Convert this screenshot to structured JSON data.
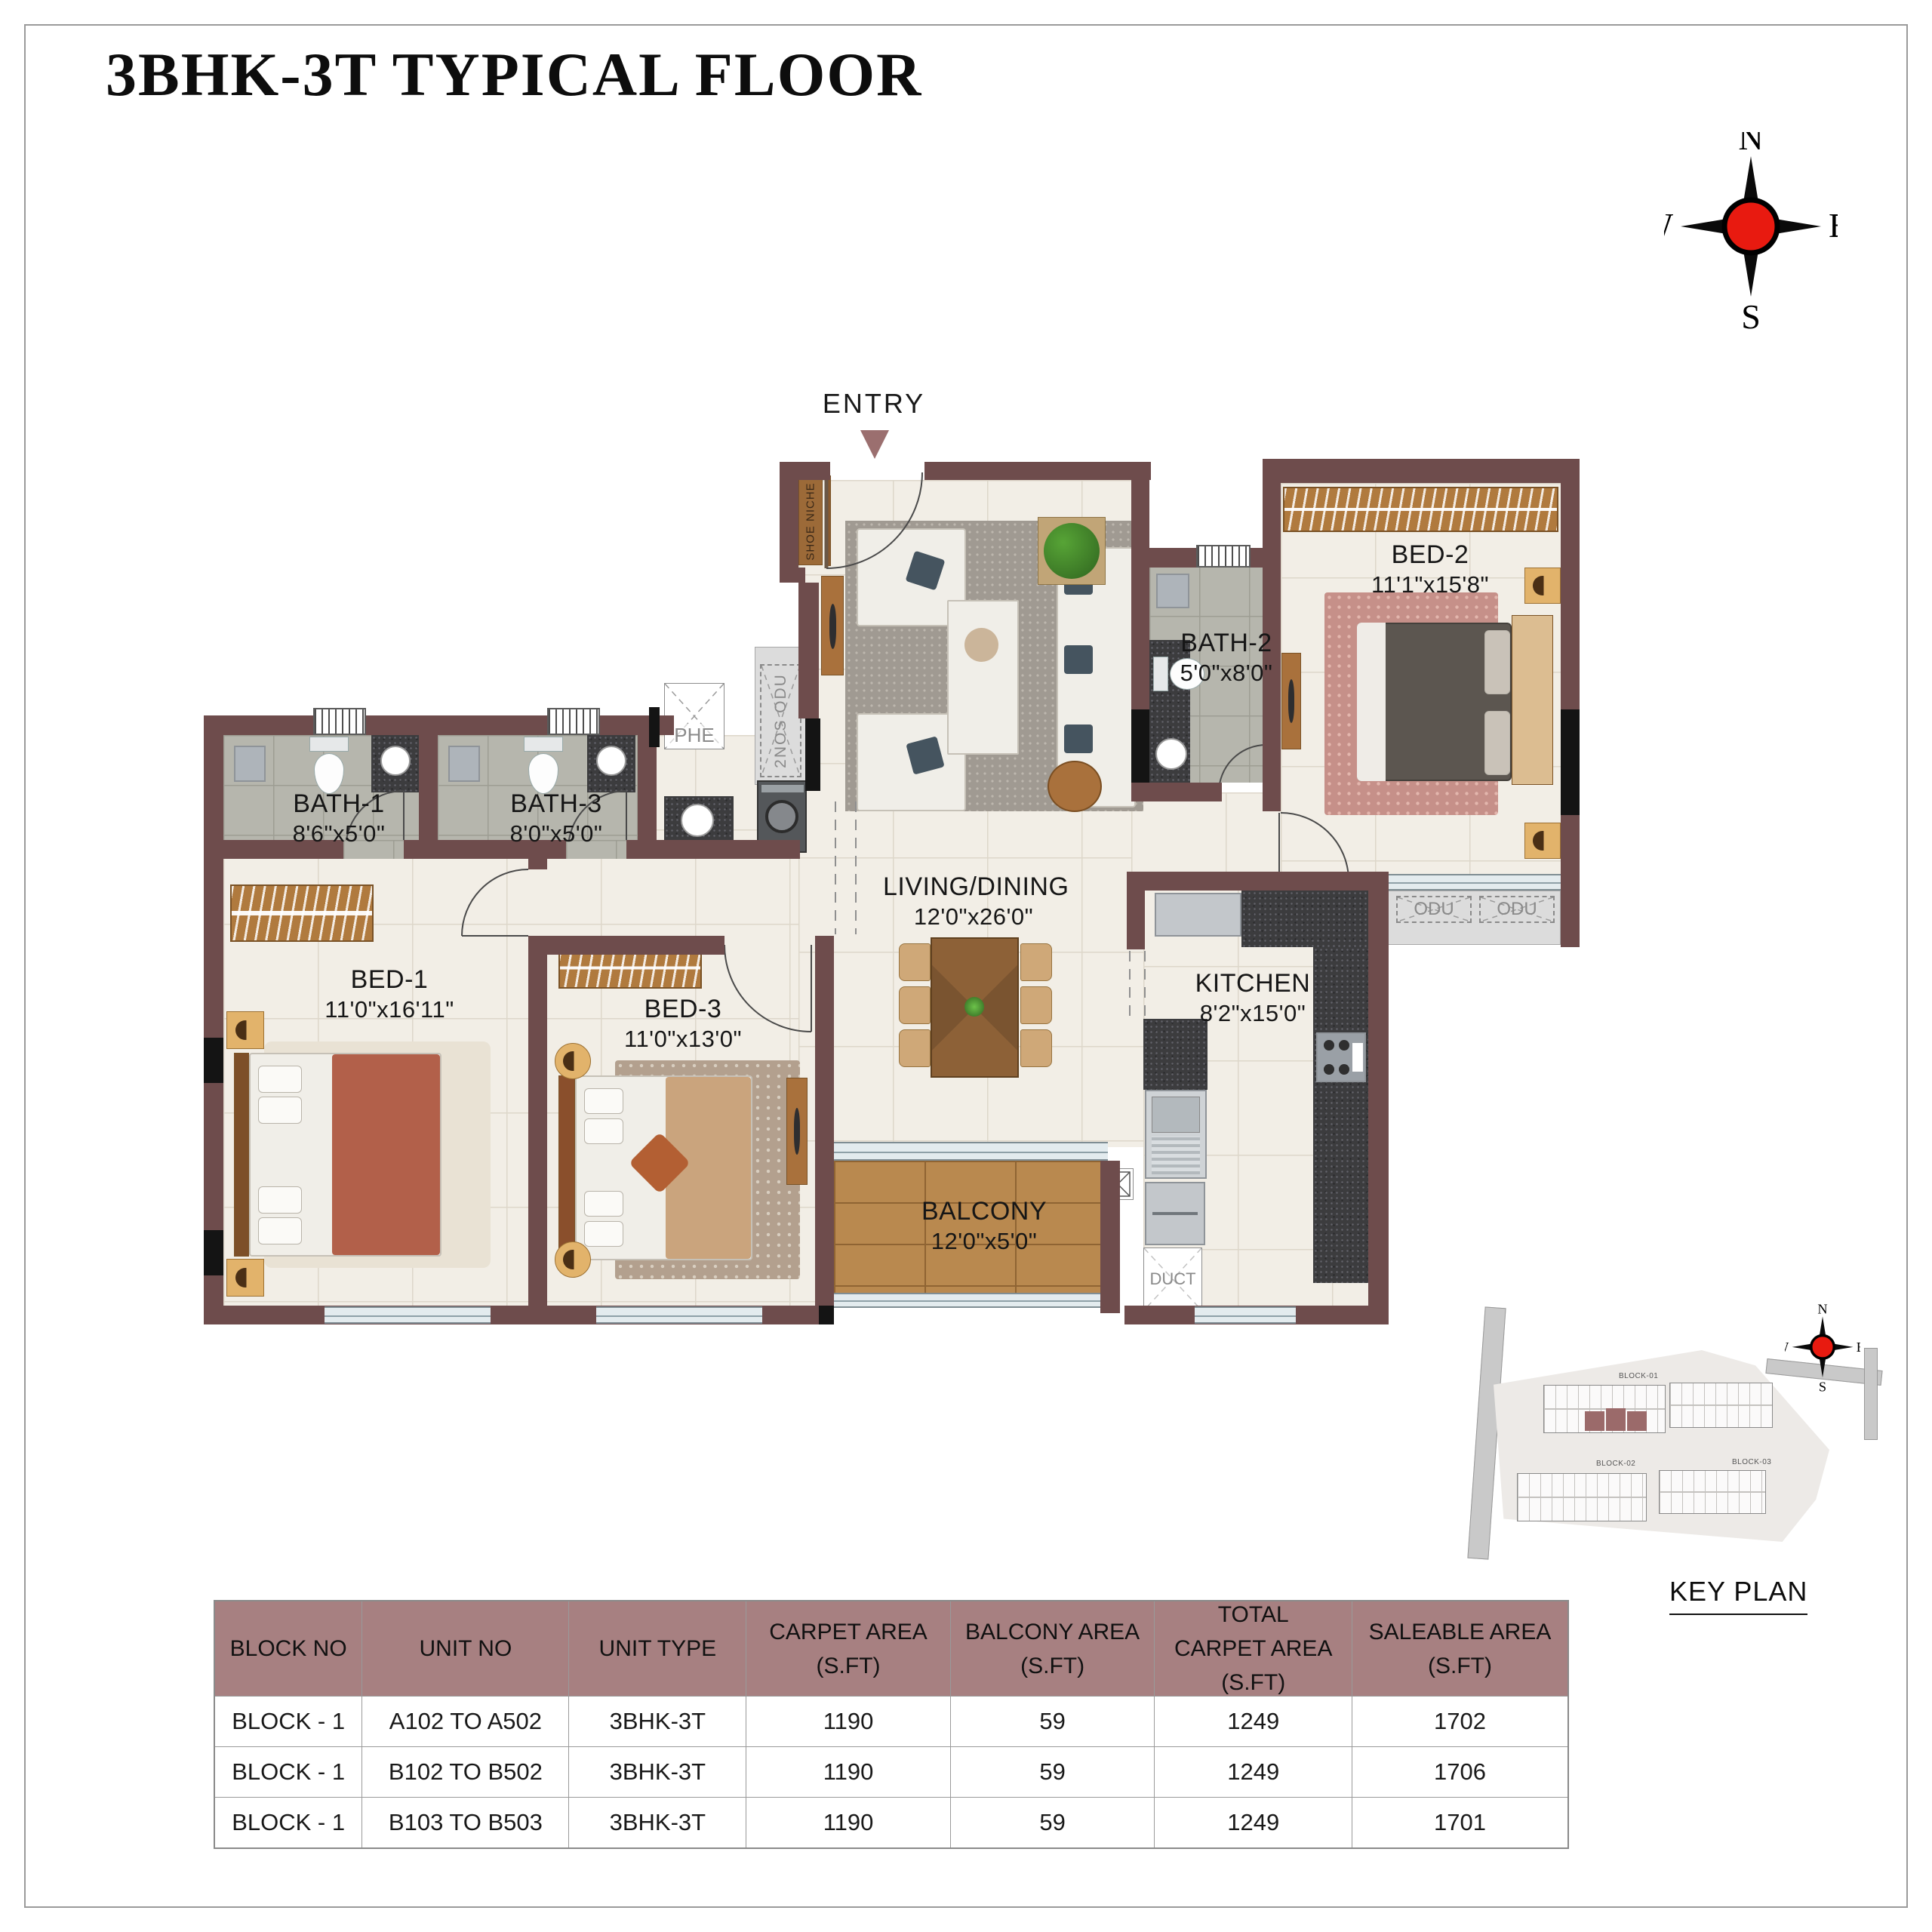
{
  "title": "3BHK-3T TYPICAL FLOOR",
  "compass": {
    "n": "N",
    "e": "E",
    "s": "S",
    "w": "W"
  },
  "plan": {
    "entry_label": "ENTRY",
    "rooms": {
      "bed1": {
        "name": "BED-1",
        "dims": "11'0\"x16'11\""
      },
      "bed2": {
        "name": "BED-2",
        "dims": "11'1\"x15'8\""
      },
      "bed3": {
        "name": "BED-3",
        "dims": "11'0\"x13'0\""
      },
      "bath1": {
        "name": "BATH-1",
        "dims": "8'6\"x5'0\""
      },
      "bath2": {
        "name": "BATH-2",
        "dims": "5'0\"x8'0\""
      },
      "bath3": {
        "name": "BATH-3",
        "dims": "8'0\"x5'0\""
      },
      "living": {
        "name": "LIVING/DINING",
        "dims": "12'0\"x26'0\""
      },
      "kitchen": {
        "name": "KITCHEN",
        "dims": "8'2\"x15'0\""
      },
      "balcony": {
        "name": "BALCONY",
        "dims": "12'0\"x5'0\""
      }
    },
    "annotations": {
      "shoe_niche": "SHOE NICHE",
      "phe": "PHE",
      "odu_2nos": "2NOS ODU",
      "odu": "ODU",
      "duct": "DUCT"
    }
  },
  "key_plan": {
    "label": "KEY PLAN",
    "blocks": [
      "BLOCK-01",
      "BLOCK-02",
      "BLOCK-03"
    ]
  },
  "table": {
    "headers": [
      {
        "lines": [
          "BLOCK NO"
        ]
      },
      {
        "lines": [
          "UNIT NO"
        ]
      },
      {
        "lines": [
          "UNIT TYPE"
        ]
      },
      {
        "lines": [
          "CARPET AREA",
          "(S.FT)"
        ]
      },
      {
        "lines": [
          "BALCONY AREA",
          "(S.FT)"
        ]
      },
      {
        "lines": [
          "TOTAL",
          "CARPET AREA",
          "(S.FT)"
        ]
      },
      {
        "lines": [
          "SALEABLE AREA",
          "(S.FT)"
        ]
      }
    ],
    "rows": [
      [
        "BLOCK - 1",
        "A102 TO A502",
        "3BHK-3T",
        "1190",
        "59",
        "1249",
        "1702"
      ],
      [
        "BLOCK - 1",
        "B102 TO B502",
        "3BHK-3T",
        "1190",
        "59",
        "1249",
        "1706"
      ],
      [
        "BLOCK - 1",
        "B103 TO B503",
        "3BHK-3T",
        "1190",
        "59",
        "1249",
        "1701"
      ]
    ]
  },
  "colors": {
    "wall": "#6e4c4c",
    "accent": "#9b6f6f",
    "table_header_bg": "#a78081",
    "compass_red": "#e81a10"
  }
}
